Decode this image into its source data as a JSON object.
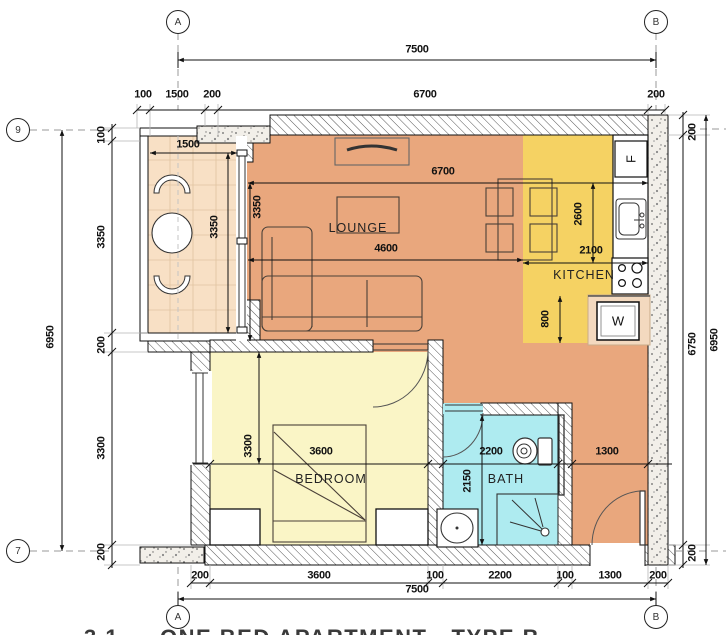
{
  "caption": {
    "number": "3.1",
    "text": "ONE BED APARTMENT - TYPE B"
  },
  "bubbles": {
    "a": "A",
    "b": "B",
    "r9": "9",
    "r7": "7"
  },
  "rooms": {
    "lounge": "LOUNGE",
    "kitchen": "KITCHEN",
    "bedroom": "BEDROOM",
    "bath": "BATH"
  },
  "appliances": {
    "fridge": "F",
    "washer": "W"
  },
  "dims": {
    "top": {
      "overall": "7500",
      "chain": [
        "100",
        "1500",
        "200",
        "6700",
        "200"
      ]
    },
    "bottom": {
      "overall": "7500",
      "chain": [
        "200",
        "3600",
        "100",
        "2200",
        "100",
        "1300",
        "200"
      ]
    },
    "left": {
      "overall": "6950",
      "chain": [
        "100",
        "3350",
        "200",
        "3300",
        "200"
      ]
    },
    "right": {
      "overall": "6950",
      "chain": [
        "200",
        "6750",
        "200"
      ]
    },
    "interior": {
      "balcony_width": "1500",
      "balcony_depth": "3350",
      "lounge_width": "6700",
      "lounge_depth": "3350",
      "sofa_width": "4600",
      "kitchen_depth": "2600",
      "kitchen_width": "2100",
      "kitchen_lower": "800",
      "bedroom_width": "3600",
      "bedroom_depth": "3300",
      "bath_width": "2200",
      "bath_depth": "2150",
      "entry_width": "1300"
    }
  },
  "colors": {
    "lounge": "#E9A77D",
    "kitchen": "#F5D263",
    "bedroom": "#FAF5C6",
    "bath": "#AEEBF0",
    "balcony": "#F8E0C5",
    "washer_niche": "#F3D9BF"
  }
}
